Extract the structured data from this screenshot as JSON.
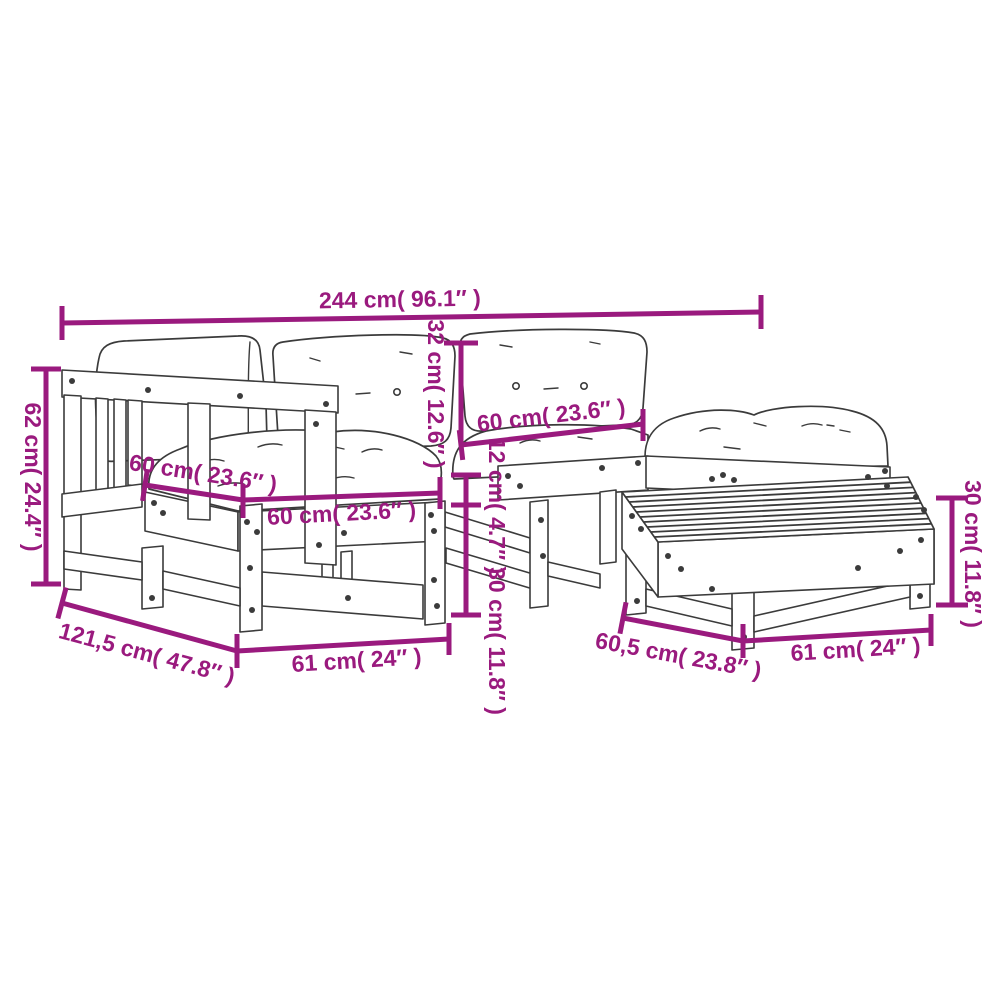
{
  "diagram": {
    "accent_color": "#9a1a7e",
    "line_color": "#3b3b3b",
    "background_color": "#ffffff",
    "dimensions": {
      "total_width": "244 cm( 96.1″ )",
      "backrest_height": "62 cm( 24.4″ )",
      "back_cushion_height": "32 cm( 12.6″ )",
      "back_cushion_width": "60 cm( 23.6″ )",
      "seat_cushion_depth": "60 cm( 23.6″ )",
      "seat_cushion_width": "60 cm( 23.6″ )",
      "seat_cushion_thickness": "12 cm( 4.7″ )",
      "seat_height": "30 cm( 11.8″ )",
      "table_height": "30 cm( 11.8″ )",
      "total_depth": "121,5 cm( 47.8″ )",
      "seat_width": "61 cm( 24″ )",
      "table_depth": "60,5 cm( 23.8″ )",
      "table_width": "61 cm( 24″ )"
    }
  }
}
